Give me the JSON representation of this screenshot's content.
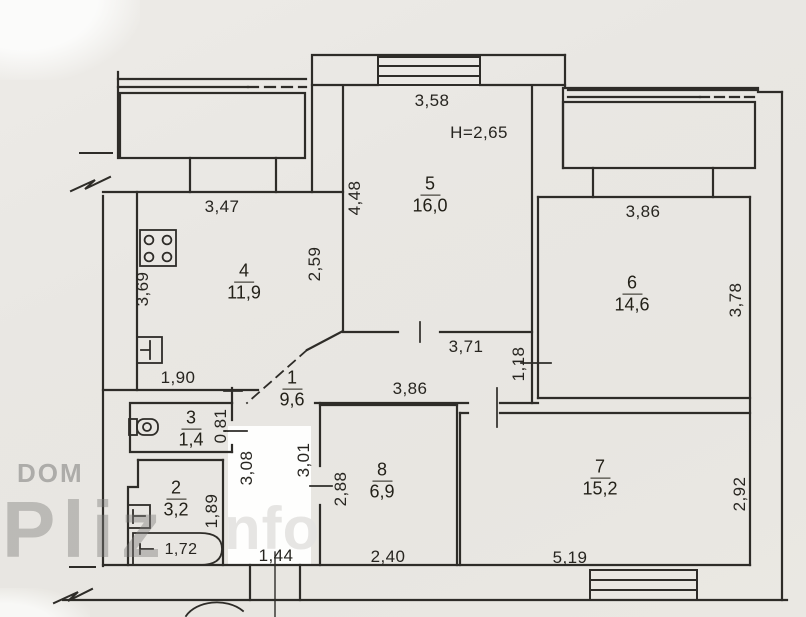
{
  "watermark": {
    "dom": "DOM",
    "pliz": "Pliz",
    "info_fragment": "nfo"
  },
  "plan": {
    "ceiling_height_label": "H=2,65",
    "rooms": {
      "r1": {
        "number": "1",
        "area": "9,6"
      },
      "r2": {
        "number": "2",
        "area": "3,2"
      },
      "r3": {
        "number": "3",
        "area": "1,4"
      },
      "r4": {
        "number": "4",
        "area": "11,9"
      },
      "r5": {
        "number": "5",
        "area": "16,0"
      },
      "r6": {
        "number": "6",
        "area": "14,6"
      },
      "r7": {
        "number": "7",
        "area": "15,2"
      },
      "r8": {
        "number": "8",
        "area": "6,9"
      }
    },
    "dims": {
      "room5_top": "3,58",
      "room5_left": "4,48",
      "room5_bottom": "3,71",
      "kitchen_top": "3,47",
      "kitchen_left": "3,69",
      "kitchen_right": "2,59",
      "kitchen_bottom": "1,90",
      "corridor_bottom": "3,86",
      "corridor_right": "1,18",
      "room6_top": "3,86",
      "room6_right": "3,78",
      "room7_right": "2,92",
      "room7_bottom": "5,19",
      "room8_left": "2,88",
      "room8_bottom": "2,40",
      "wc_height": "0,81",
      "bath_height": "1,89",
      "bathtub_length": "1,72",
      "hall_left": "3,08",
      "hall_right": "3,01",
      "entry_width": "1,44"
    }
  }
}
